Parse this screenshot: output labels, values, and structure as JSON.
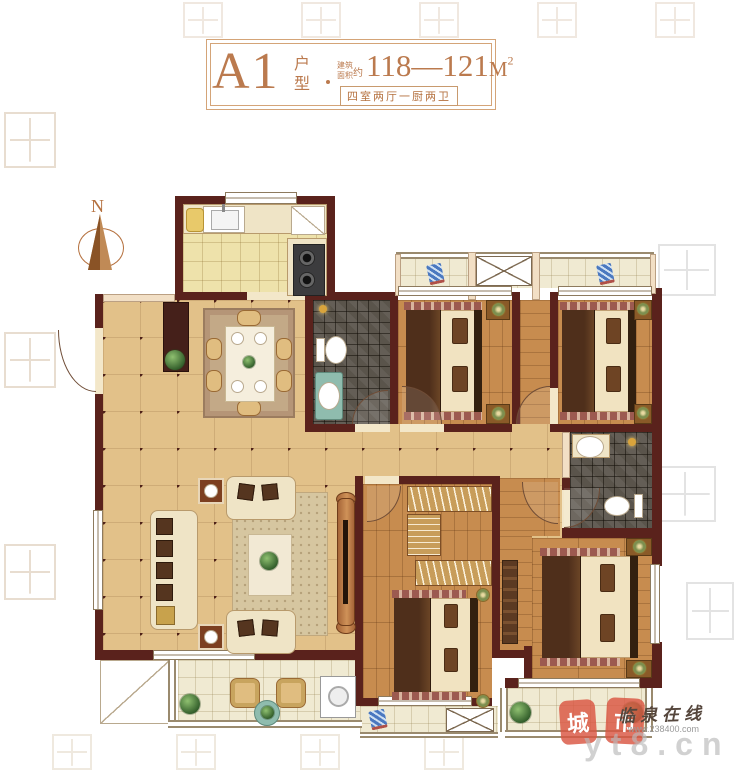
{
  "title_block": {
    "unit_name": "A1",
    "unit_type_char1": "户",
    "unit_type_char2": "型",
    "area_label_line1": "建筑",
    "area_label_line2": "面积",
    "area_label_approx": "约",
    "area_value": "118—121",
    "area_unit_base": "M",
    "area_unit_exponent": "2",
    "layout_spec": "四室两厅一厨两卫",
    "frame_color": "#d4a478",
    "text_color": "#bb7a4e"
  },
  "compass": {
    "label": "N",
    "color": "#c08a56"
  },
  "watermarks": {
    "stamp_char_1": "城",
    "stamp_char_2": "市",
    "script_brand": "临泉在线",
    "small_url": "www.238400.com",
    "large_url": "yt8.cn",
    "stamp_color": "#d9564a"
  },
  "palette": {
    "wall": "#5a221c",
    "tile_floor": "#e2c189",
    "wood_floor": "#c78c4f",
    "kitchen_floor": "#eee2ab",
    "balcony_floor": "#f0ead2",
    "bath_mosaic": "#5a544b",
    "light_wall": "#f2dfc5"
  }
}
